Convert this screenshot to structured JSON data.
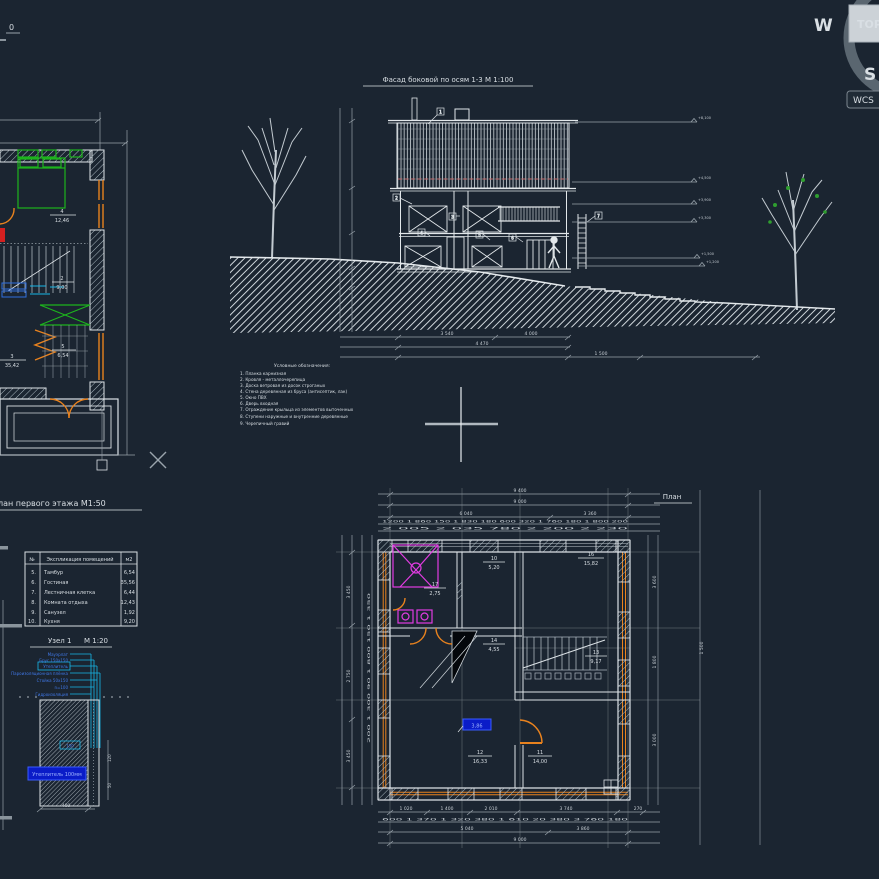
{
  "viewcube": {
    "west": "W",
    "south": "S",
    "top_face": "TOP",
    "wcs": "WCS"
  },
  "corner": {
    "label": "0"
  },
  "facade": {
    "title": "Фасад боковой по осям 1-3 М 1:100",
    "levels": [
      "+8,100",
      "+4,500",
      "+3,900",
      "+3,300",
      "+1,500",
      "+1,200"
    ],
    "dims": {
      "d1": "3 540",
      "d2": "4 000",
      "d3": "4 470",
      "d4": "1 500"
    },
    "callouts": [
      "1",
      "2",
      "3",
      "4",
      "5",
      "6",
      "7"
    ],
    "legend_title": "Условные обозначения:",
    "legend": [
      "1. Планка карнизная",
      "2. Кровля - металлочерепица",
      "3. Доска ветровая из досок строганых",
      "4. Стена деревянная из бруса (антисептик, лак)",
      "5. Окно ПВХ",
      "6. Дверь входная",
      "7. Ограждение крыльца из элементов выточенных",
      "8. Ступени наружные и внутренние деревянные",
      "9. Черепичный гравий"
    ]
  },
  "left_plan": {
    "title": "План первого этажа М1:50",
    "rooms": [
      {
        "num": "4",
        "area": "12,46"
      },
      {
        "num": "2",
        "area": "9,00"
      },
      {
        "num": "5",
        "area": "6,54"
      },
      {
        "num": "3",
        "area": "35,42"
      }
    ]
  },
  "table": {
    "header": {
      "num": "№",
      "name": "Экспликация помещений",
      "area": "м2"
    },
    "rows": [
      {
        "num": "5.",
        "name": "Тамбур",
        "area": "6,54"
      },
      {
        "num": "6.",
        "name": "Гостиная",
        "area": "35,56"
      },
      {
        "num": "7.",
        "name": "Лестничная клетка",
        "area": "6,44"
      },
      {
        "num": "8.",
        "name": "Комната отдыха",
        "area": "12,43"
      },
      {
        "num": "9.",
        "name": "Санузел",
        "area": "1,92"
      },
      {
        "num": "10.",
        "name": "Кухня",
        "area": "9,20"
      }
    ]
  },
  "node": {
    "title": "Узел 1",
    "scale": "М 1:20",
    "notes": [
      "Мауэрлат",
      "Брус 150х150",
      "Утеплитель",
      "Пароизоляционная плёнка",
      "Стойка 50х150",
      "n=100",
      "Гидроизоляция"
    ],
    "highlight": "Утеплитель 100мм",
    "dims": {
      "w": "400",
      "s1": "150",
      "s2": "120",
      "s3": "50"
    }
  },
  "plan": {
    "title": "План",
    "top": {
      "total": "9 400",
      "inner": "9 000",
      "left": "6 040",
      "right": "3 360",
      "chain1": "1200  1 860  150 1 830 180  600  320 1 760 180  1 800 200",
      "chain2": "2 005      2 035      780      2 200      2 230"
    },
    "bottom": {
      "r1": [
        "1 020",
        "1 400",
        "2 010",
        "3 740",
        "270"
      ],
      "chain": "600 1 370   1 320   380 1 610 20  380   3 760   180",
      "r3": [
        "5 040",
        "3 860"
      ],
      "total": "9 000"
    },
    "left": {
      "vals": [
        "3 450",
        "2 750",
        "3 450"
      ],
      "chain": "200 1 300 90 1 800 150 1 350"
    },
    "right": {
      "vals": [
        "3 600",
        "1 800",
        "3 000"
      ],
      "outer": "1 500"
    },
    "rooms": [
      {
        "num": "17",
        "area": "2,75"
      },
      {
        "num": "10",
        "area": "5,20"
      },
      {
        "num": "16",
        "area": "15,82"
      },
      {
        "num": "14",
        "area": "4,55"
      },
      {
        "num": "13",
        "area": "9,17"
      },
      {
        "num": "12",
        "area": "16,33"
      },
      {
        "num": "11",
        "area": "14,00"
      }
    ],
    "selected": "3,86"
  },
  "colors": {
    "bg": "#1b2531",
    "line": "#dce2e6",
    "dim": "#98a2aa",
    "green": "#1db41d",
    "orange": "#e8821e",
    "magenta": "#e23ce2",
    "blue": "#2f6fe0",
    "cyan": "#17b7e8",
    "red": "#d42020",
    "roof_dash": "#c46a6a",
    "select_fill": "#0a1cc8"
  }
}
